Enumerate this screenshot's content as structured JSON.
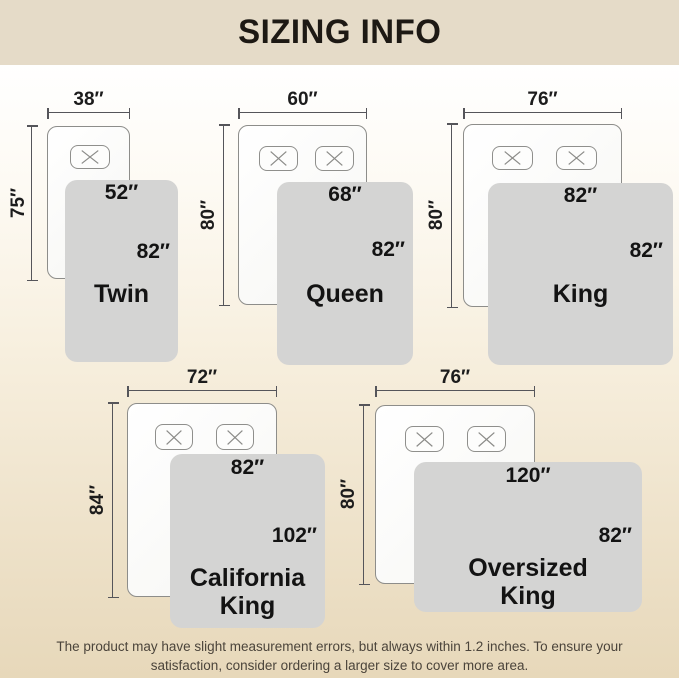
{
  "title": "SIZING INFO",
  "colors": {
    "banner_bg": "#e5dbc8",
    "title_color": "#1d1914",
    "blanket_fill": "#d4d4d3",
    "dimension_line": "#55555a",
    "background_bottom": "#e7d8ba",
    "footer_text": "#4b443b"
  },
  "diagrams": [
    {
      "name": "Twin",
      "bed_width": "38″",
      "bed_height": "75″",
      "blanket_width": "52″",
      "blanket_height": "82″",
      "pillows": 1
    },
    {
      "name": "Queen",
      "bed_width": "60″",
      "bed_height": "80″",
      "blanket_width": "68″",
      "blanket_height": "82″",
      "pillows": 2
    },
    {
      "name": "King",
      "bed_width": "76″",
      "bed_height": "80″",
      "blanket_width": "82″",
      "blanket_height": "82″",
      "pillows": 2
    },
    {
      "name": "California King",
      "bed_width": "72″",
      "bed_height": "84″",
      "blanket_width": "82″",
      "blanket_height": "102″",
      "pillows": 2
    },
    {
      "name": "Oversized King",
      "bed_width": "76″",
      "bed_height": "80″",
      "blanket_width": "120″",
      "blanket_height": "82″",
      "pillows": 2
    }
  ],
  "footer": {
    "line1": "The product may have slight measurement errors, but always within 1.2 inches. To ensure your",
    "line2": "satisfaction, consider ordering a larger size to cover more area."
  }
}
